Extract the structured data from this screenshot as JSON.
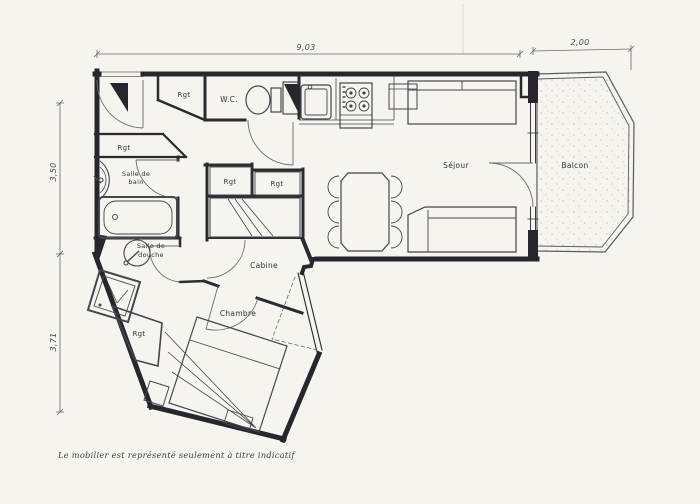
{
  "document": {
    "note": "Le mobilier est représenté seulement à titre indicatif"
  },
  "dimensions": {
    "width_main": "9,03",
    "width_balcony": "2,00",
    "height_upper": "3,50",
    "height_lower": "3,71"
  },
  "rooms": {
    "sejour": "Séjour",
    "balcon": "Balcon",
    "chambre": "Chambre",
    "cabine": "Cabine",
    "wc": "W.C.",
    "salle_de_bain_l1": "Salle de",
    "salle_de_bain_l2": "bain",
    "salle_de_douche_l1": "Salle de",
    "salle_de_douche_l2": "douche",
    "storage": "Rgt"
  },
  "colors": {
    "paper": "#f5f4ef",
    "wall_ink": "#26262c",
    "pencil": "#6a6a72"
  }
}
